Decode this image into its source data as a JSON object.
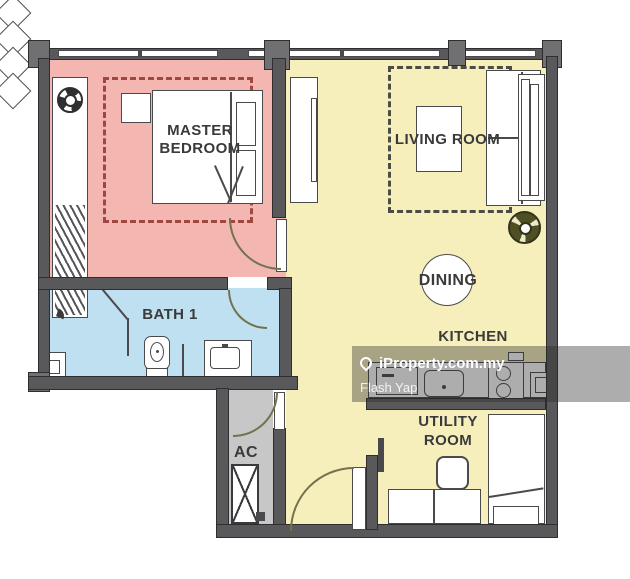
{
  "rooms": {
    "master_bedroom": {
      "line1": "MASTER",
      "line2": "BEDROOM"
    },
    "living_room": {
      "label": "LIVING ROOM"
    },
    "dining": {
      "label": "DINING"
    },
    "kitchen": {
      "label": "KITCHEN"
    },
    "bath_1": {
      "label": "BATH 1"
    },
    "ac": {
      "label": "AC"
    },
    "utility_room": {
      "line1": "UTILITY",
      "line2": "ROOM"
    }
  },
  "watermark": {
    "brand": "iProperty.com.my",
    "author": "Flash Yap"
  },
  "icons": {
    "bedroom_fan": "ceiling-fan-icon",
    "living_fan": "ceiling-fan-icon",
    "shower": "shower-head-icon",
    "ac_unit": "ac-unit-cross-box",
    "watermark_pin": "location-pin-icon"
  },
  "colors": {
    "bedroom_fill": "#f3b6b0",
    "living_fill": "#f6efbb",
    "bath_fill": "#bfe0f0",
    "ac_fill": "#c7c7c7",
    "wall": "#59595b",
    "bedroom_zone_dash": "#a04840",
    "living_zone_dash": "#4c4c46",
    "living_fan_color": "#4f4f24",
    "watermark_overlay": "rgba(40,40,40,0.38)"
  }
}
